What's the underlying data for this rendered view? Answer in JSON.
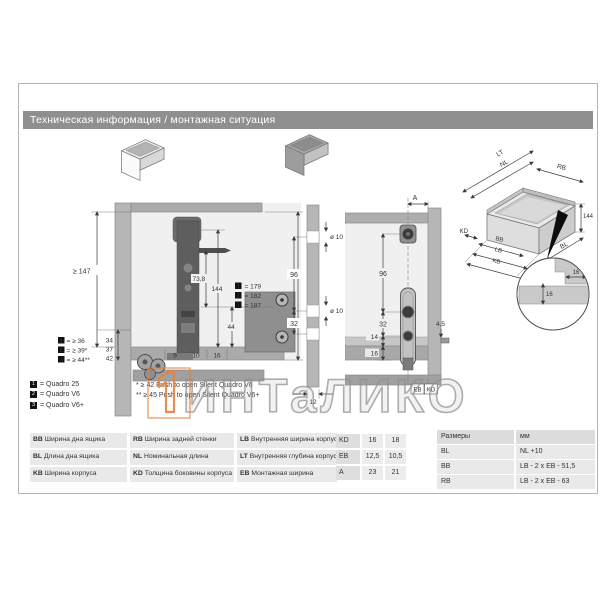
{
  "header": {
    "title": "Техническая информация / монтажная ситуация"
  },
  "watermark": {
    "text": "ИНТаЛИКО",
    "accent_orange": "#e8823a"
  },
  "side": {
    "min_height": "≥ 147",
    "d738": "73,8",
    "d144": "144",
    "d44": "44",
    "heights": [
      {
        "n": "1",
        "v": "= 179"
      },
      {
        "n": "2",
        "v": "= 182"
      },
      {
        "n": "3",
        "v": "= 187"
      }
    ],
    "offsets": [
      "34",
      "37",
      "42"
    ],
    "gaps": [
      {
        "n": "1",
        "v": "= ≥ 36"
      },
      {
        "n": "2",
        "v": "= ≥ 39*"
      },
      {
        "n": "3",
        "v": "= ≥ 44**"
      }
    ],
    "bottom": [
      "9",
      "10",
      "16"
    ]
  },
  "drill": {
    "dia_top": "ø 10",
    "d96": "96",
    "dia_mid": "ø 10",
    "d32": "32",
    "d12": "12"
  },
  "rear": {
    "a": "A",
    "d96": "96",
    "d32": "32",
    "d14": "14",
    "d16": "16",
    "d45": "4,5",
    "eb": "EB",
    "kd": "KD"
  },
  "iso": {
    "lt": "LT",
    "nl": "NL",
    "rb": "RB",
    "h": "144",
    "kd": "KD",
    "bb": "BB",
    "bl": "BL",
    "lb": "LB",
    "kb": "KB",
    "det_h": "16",
    "det_v": "16"
  },
  "models": [
    {
      "n": "1",
      "v": "= Quadro 25"
    },
    {
      "n": "2",
      "v": "= Quadro V6"
    },
    {
      "n": "3",
      "v": "= Quadro V6+"
    }
  ],
  "footnotes": [
    "* ≥ 42 Push to open Silent Quadro V6",
    "** ≥ 45 Push to open Silent Quadro V6+"
  ],
  "abbr_table": {
    "rows": [
      [
        {
          "abbr": "BB",
          "desc": "Ширина дна ящика"
        },
        {
          "abbr": "RB",
          "desc": "Ширина задней стенки"
        },
        {
          "abbr": "LB",
          "desc": "Внутренняя ширина корпуса"
        }
      ],
      [
        {
          "abbr": "BL",
          "desc": "Длина дна ящика"
        },
        {
          "abbr": "NL",
          "desc": "Номинальная длина"
        },
        {
          "abbr": "LT",
          "desc": "Внутренняя глубина корпуса"
        }
      ],
      [
        {
          "abbr": "KB",
          "desc": "Ширина корпуса"
        },
        {
          "abbr": "KD",
          "desc": "Толщина боковины корпуса"
        },
        {
          "abbr": "EB",
          "desc": "Монтажная ширина"
        }
      ]
    ]
  },
  "param_table": {
    "rows": [
      {
        "label": "KD",
        "v1": "16",
        "v2": "18"
      },
      {
        "label": "EB",
        "v1": "12,5",
        "v2": "10,5"
      },
      {
        "label": "A",
        "v1": "23",
        "v2": "21"
      }
    ]
  },
  "size_table": {
    "header": {
      "c1": "Размеры",
      "c2": "мм"
    },
    "rows": [
      {
        "c1": "BL",
        "c2": "NL +10"
      },
      {
        "c1": "BB",
        "c2": "LB - 2 x EB - 51,5"
      },
      {
        "c1": "RB",
        "c2": "LB - 2 x EB - 63"
      }
    ]
  },
  "colors": {
    "header_gray": "#8f8f8f",
    "panel_gray": "#b6b6b6",
    "profile_dark": "#5e5e5e"
  }
}
